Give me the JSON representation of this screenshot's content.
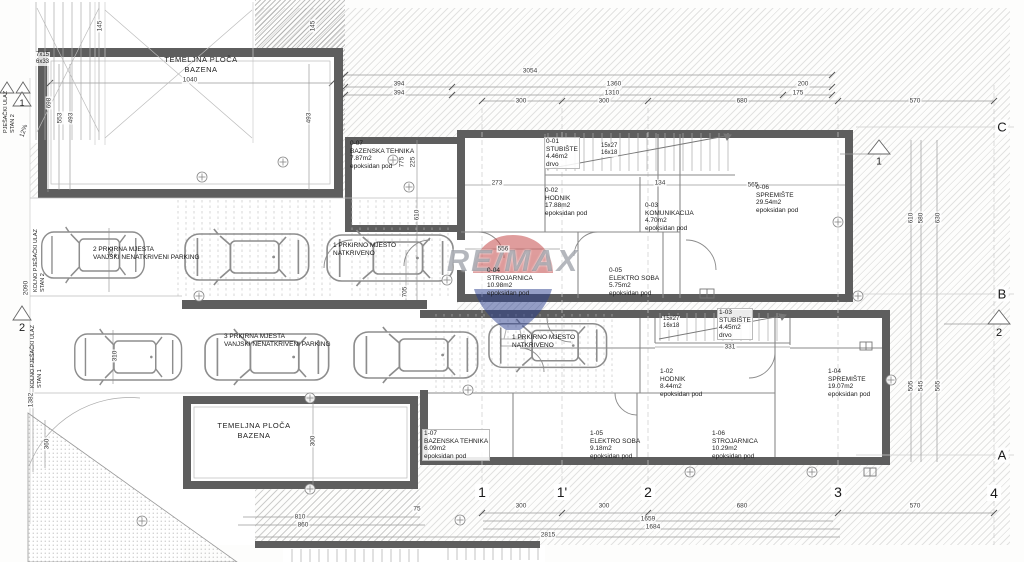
{
  "watermark": {
    "text": "RE/MAX"
  },
  "pools": {
    "top": {
      "line1": "TEMELJNA PLOČA",
      "line2": "BAZENA"
    },
    "bottom": {
      "line1": "TEMELJNA PLOČA",
      "line2": "BAZENA"
    }
  },
  "rooms": {
    "r007": {
      "id": "0-07",
      "name": "BAZENSKA TEHNIKA",
      "area": "7.87m2",
      "floor": "epoksidan pod"
    },
    "r001": {
      "id": "0-01",
      "name": "STUBIŠTE",
      "area": "4.46m2",
      "floor": "drvo"
    },
    "r002": {
      "id": "0-02",
      "name": "HODNIK",
      "area": "17.88m2",
      "floor": "epoksidan pod"
    },
    "r003": {
      "id": "0-03",
      "name": "KOMUNIKACIJA",
      "area": "4.70m2",
      "floor": "epoksidan pod"
    },
    "r004": {
      "id": "0-04",
      "name": "STROJARNICA",
      "area": "10.98m2",
      "floor": "epoksidan pod"
    },
    "r005": {
      "id": "0-05",
      "name": "ELEKTRO SOBA",
      "area": "5.75m2",
      "floor": "epoksidan pod"
    },
    "r006": {
      "id": "0-06",
      "name": "SPREMIŠTE",
      "area": "29.54m2",
      "floor": "epoksidan pod"
    },
    "r102": {
      "id": "1-02",
      "name": "HODNIK",
      "area": "8.44m2",
      "floor": "epoksidan pod"
    },
    "r103": {
      "id": "1-03",
      "name": "STUBIŠTE",
      "area": "4.45m2",
      "floor": "drvo"
    },
    "r104": {
      "id": "1-04",
      "name": "SPREMIŠTE",
      "area": "19.07m2",
      "floor": "epoksidan pod"
    },
    "r105": {
      "id": "1-05",
      "name": "ELEKTRO SOBA",
      "area": "9.18m2",
      "floor": "epoksidan pod"
    },
    "r106": {
      "id": "1-06",
      "name": "STROJARNICA",
      "area": "10.29m2",
      "floor": "epoksidan pod"
    },
    "r107": {
      "id": "1-07",
      "name": "BAZENSKA TEHNIKA",
      "area": "6.09m2",
      "floor": "epoksidan pod"
    }
  },
  "parking": {
    "p2": {
      "line1": "2 PRKIRNA MJESTA",
      "line2": "VANJSKI NENATKRIVENI PARKING"
    },
    "p3": {
      "line1": "3 PRKIRNA MJESTA",
      "line2": "VANJSKI NENATKRIVENI PARKING"
    },
    "p1a": {
      "line1": "1 PRKIRNO MJESTO",
      "line2": "NATKRIVENO"
    },
    "p1b": {
      "line1": "1 PRKIRNO MJESTO",
      "line2": "NATKRIVENO"
    }
  },
  "stairs": {
    "entry": {
      "line1": "7x15",
      "line2": "6x33"
    },
    "s0": {
      "line1": "15x27",
      "line2": "16x18"
    },
    "s1": {
      "line1": "15x27",
      "line2": "16x18"
    }
  },
  "grid": {
    "cols": [
      "1",
      "1'",
      "2",
      "3",
      "4"
    ],
    "rows": [
      "C",
      "B",
      "A"
    ],
    "left_markers": [
      "1",
      "2"
    ],
    "right_markers": [
      "1",
      "2"
    ]
  },
  "access": {
    "top_line1": "PJEŠAČKI ULAZ",
    "top_line2": "STAN 2",
    "mid_line1": "KOLNO PJEŠAČKI ULAZ",
    "mid_line2": "STAN 2",
    "bot_line1": "KOLNO PJEŠAČKI ULAZ",
    "bot_line2": "STAN 1"
  },
  "dim_labels": [
    {
      "t": "3054",
      "x": 530,
      "y": 71
    },
    {
      "t": "394",
      "x": 399,
      "y": 84
    },
    {
      "t": "1360",
      "x": 614,
      "y": 84
    },
    {
      "t": "200",
      "x": 803,
      "y": 84
    },
    {
      "t": "394",
      "x": 399,
      "y": 93
    },
    {
      "t": "1310",
      "x": 612,
      "y": 93
    },
    {
      "t": "175",
      "x": 798,
      "y": 93
    },
    {
      "t": "300",
      "x": 521,
      "y": 101
    },
    {
      "t": "300",
      "x": 604,
      "y": 101
    },
    {
      "t": "680",
      "x": 742,
      "y": 101
    },
    {
      "t": "570",
      "x": 915,
      "y": 101
    },
    {
      "t": "1040",
      "x": 190,
      "y": 80
    },
    {
      "t": "698",
      "x": 49,
      "y": 103,
      "r": -90
    },
    {
      "t": "553",
      "x": 60,
      "y": 118,
      "r": -90
    },
    {
      "t": "493",
      "x": 71,
      "y": 118,
      "r": -90
    },
    {
      "t": "493",
      "x": 309,
      "y": 118,
      "r": -90
    },
    {
      "t": "145",
      "x": 100,
      "y": 26,
      "r": -90
    },
    {
      "t": "145",
      "x": 313,
      "y": 26,
      "r": -90
    },
    {
      "t": "12%",
      "x": 24,
      "y": 131,
      "r": -72
    },
    {
      "t": "2090",
      "x": 26,
      "y": 288,
      "r": -90
    },
    {
      "t": "355",
      "x": 111,
      "y": 252,
      "r": -90
    },
    {
      "t": "310",
      "x": 115,
      "y": 356,
      "r": -90
    },
    {
      "t": "1382",
      "x": 31,
      "y": 400,
      "r": -90
    },
    {
      "t": "360",
      "x": 47,
      "y": 444,
      "r": -90
    },
    {
      "t": "610",
      "x": 417,
      "y": 215,
      "r": -90
    },
    {
      "t": "705",
      "x": 405,
      "y": 292,
      "r": -90
    },
    {
      "t": "775",
      "x": 402,
      "y": 162,
      "r": -90
    },
    {
      "t": "225",
      "x": 413,
      "y": 162,
      "r": -90
    },
    {
      "t": "273",
      "x": 497,
      "y": 183
    },
    {
      "t": "134",
      "x": 660,
      "y": 183
    },
    {
      "t": "565",
      "x": 753,
      "y": 185
    },
    {
      "t": "556",
      "x": 503,
      "y": 249
    },
    {
      "t": "331",
      "x": 730,
      "y": 347
    },
    {
      "t": "610",
      "x": 911,
      "y": 218,
      "r": -90
    },
    {
      "t": "580",
      "x": 921,
      "y": 218,
      "r": -90
    },
    {
      "t": "630",
      "x": 938,
      "y": 218,
      "r": -90
    },
    {
      "t": "505",
      "x": 911,
      "y": 386,
      "r": -90
    },
    {
      "t": "545",
      "x": 921,
      "y": 386,
      "r": -90
    },
    {
      "t": "565",
      "x": 938,
      "y": 386,
      "r": -90
    },
    {
      "t": "300",
      "x": 313,
      "y": 441,
      "r": -90
    },
    {
      "t": "300",
      "x": 521,
      "y": 506
    },
    {
      "t": "300",
      "x": 604,
      "y": 506
    },
    {
      "t": "680",
      "x": 742,
      "y": 506
    },
    {
      "t": "570",
      "x": 915,
      "y": 506
    },
    {
      "t": "75",
      "x": 417,
      "y": 509
    },
    {
      "t": "810",
      "x": 300,
      "y": 517
    },
    {
      "t": "860",
      "x": 303,
      "y": 525
    },
    {
      "t": "1659",
      "x": 648,
      "y": 519
    },
    {
      "t": "1684",
      "x": 653,
      "y": 527
    },
    {
      "t": "2815",
      "x": 548,
      "y": 535
    }
  ]
}
